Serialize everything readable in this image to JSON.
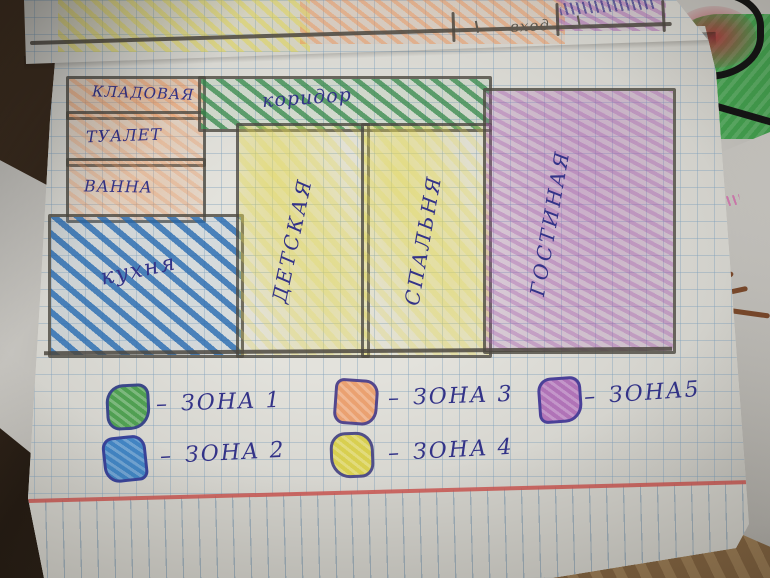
{
  "floor_plan": {
    "rooms": [
      {
        "label": "КЛАДОВАЯ",
        "zone": 3
      },
      {
        "label": "ТУАЛЕТ",
        "zone": 3
      },
      {
        "label": "ВАННА",
        "zone": 3
      },
      {
        "label": "кухня",
        "zone": 2
      },
      {
        "label": "коридор",
        "zone": 1
      },
      {
        "label": "ДЕТСКАЯ",
        "zone": 4
      },
      {
        "label": "СПАЛЬНЯ",
        "zone": 4
      },
      {
        "label": "ГОСТИНАЯ",
        "zone": 5
      }
    ],
    "entrance_label": "вход"
  },
  "legend": {
    "separator": "–",
    "items": [
      {
        "label": "ЗОНА 1",
        "zone": 1,
        "color_name": "green",
        "hex": "#4da04f"
      },
      {
        "label": "ЗОНА 2",
        "zone": 2,
        "color_name": "blue",
        "hex": "#3f86c8"
      },
      {
        "label": "ЗОНА 3",
        "zone": 3,
        "color_name": "orange",
        "hex": "#eda06e"
      },
      {
        "label": "ЗОНА 4",
        "zone": 4,
        "color_name": "yellow",
        "hex": "#d9cf4a"
      },
      {
        "label": "ЗОНА5",
        "zone": 5,
        "color_name": "purple",
        "hex": "#b272ba"
      }
    ]
  },
  "colors": {
    "ink": "#33338c",
    "pencil_line": "#4f4b45",
    "red_margin_line": "#d0554f",
    "grid_line": "#9db8cc"
  }
}
